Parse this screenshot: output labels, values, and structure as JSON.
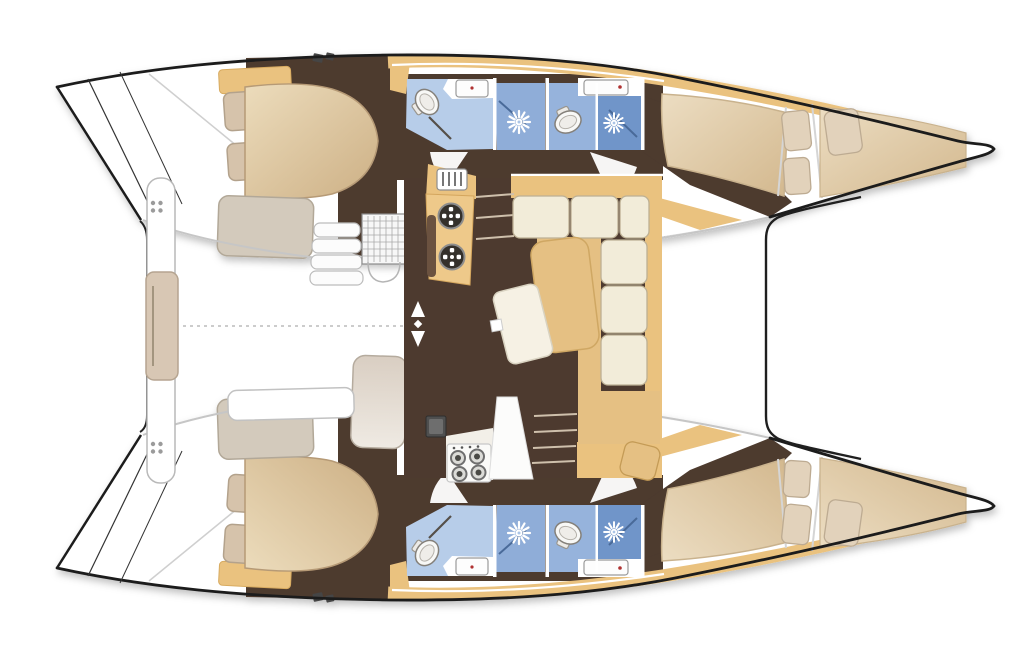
{
  "figure": {
    "kind": "catamaran-deck-floor-plan",
    "orientation": "bow-right-stern-left"
  },
  "palette": {
    "paper": "#ffffff",
    "outline": "#1c1c1c",
    "floor": "#4d3a2f",
    "tan": "#eac27f",
    "tan2": "#e5c083",
    "counter": "#eec98a",
    "bed": "#d8bd96",
    "cream": "#f2ecd9",
    "pillow": "#d6c3ab",
    "bench": "#d3cabc",
    "blue-light": "#b7cde9",
    "blue-mid": "#96b3dc",
    "blue-shower": "#8fadd8",
    "blue-dark": "#7095c9",
    "grey-line": "#c6c6c6"
  },
  "icons": {
    "shower": "white starburst rose",
    "toilet": "white oval bowl with tank",
    "sink": "white rectangle with faucet dot",
    "galley-round-sink": "dark ring with four white dots",
    "stove-burner": "grey ring with dark center",
    "cleat": "four grey dots 2x2",
    "companionway": "white up/down arrows"
  },
  "areas": [
    {
      "name": "port-aft-cabin"
    },
    {
      "name": "port-bathrooms"
    },
    {
      "name": "port-forward-cabin"
    },
    {
      "name": "starboard-aft-cabin"
    },
    {
      "name": "starboard-bathrooms"
    },
    {
      "name": "starboard-forward-cabin"
    },
    {
      "name": "salon-with-l-sofa"
    },
    {
      "name": "galley"
    },
    {
      "name": "cockpit-with-aft-bench"
    },
    {
      "name": "foredeck"
    }
  ]
}
